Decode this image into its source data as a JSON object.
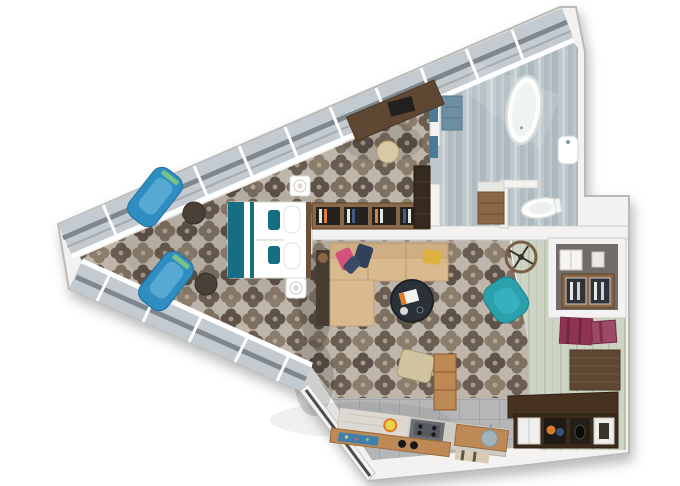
{
  "title": "hotel-suite-3d-floor-plan-top-view",
  "palette": {
    "wall": "#f3f2f0",
    "wall_edge": "#b9b9b6",
    "inner_wall_edge": "#d2d1cd",
    "glass": "#c3cad0",
    "glass_rail": "#7e878e",
    "carpet_bg": "#beb6aa",
    "carpet_dark": "#5e5349",
    "carpet_mid": "#7d7061",
    "carpet_light": "#8b7d6c",
    "carpet_deep": "#695c50",
    "bath_floor": "#bcc6cb",
    "bath_streak_dark": "#aeb9bf",
    "bath_streak_light": "#ced7da",
    "hall_floor": "#ced4c4",
    "hall_streak": "#b9c0ae",
    "kitchen_floor": "#b4b6b8",
    "kitchen_line": "#a4a7a9",
    "accent_teal": "#156e81",
    "chair_blue": "#2f8ec1",
    "chair_blue_light": "#57a8d3",
    "armchair_teal": "#2ba1ae",
    "sofa_tan": "#d9ba8e",
    "sofa_back": "#cfae83",
    "sofa_dark": "#473c31",
    "wood_dark": "#5f4833",
    "wood_mid": "#8a6747",
    "wood_light": "#bd8a55",
    "bench_wood": "#46321f",
    "table_navy": "#2b3139",
    "pillow_pink": "#d5507b",
    "pillow_navy": "#303f5a",
    "pillow_yellow": "#ddb13e",
    "mat_red": "#8f3353",
    "mat_red2": "#9c4a66",
    "niche_wall": "#716c67",
    "fridge_glass": "#2f343c",
    "towel_blue": "#4a7b96",
    "stool_beige": "#d8c9a4",
    "ottoman_beige": "#cfc49f",
    "kitchen_mat_blue": "#3e7fae",
    "white": "#ffffff"
  },
  "rooms": [
    {
      "name": "bedroom",
      "floor": "patterned-carpet",
      "furniture": [
        "double-bed-white-teal",
        "nightstand-with-lamp-top",
        "nightstand-with-lamp-bottom",
        "blue-lounge-chair-1",
        "blue-lounge-chair-2",
        "round-side-table-1",
        "round-side-table-2",
        "wall-desk-with-chair",
        "desk-stool",
        "low-bookshelf",
        "dark-wardrobe"
      ]
    },
    {
      "name": "bathroom",
      "floor": "grey-stone",
      "furniture": [
        "freestanding-bathtub",
        "wood-vanity",
        "toilet",
        "wall-hung-sink",
        "towel-shelf"
      ]
    },
    {
      "name": "living-room",
      "floor": "patterned-carpet",
      "furniture": [
        "corner-sofa-with-pillows",
        "round-coffee-table",
        "teal-accent-armchair",
        "beige-ottoman",
        "round-wheel-decor"
      ]
    },
    {
      "name": "kitchen",
      "floor": "grey-tile",
      "furniture": [
        "counter-with-cooktop",
        "wood-bar-front",
        "sink-counter",
        "tall-wood-cabinet",
        "fruit-plate"
      ]
    },
    {
      "name": "entry-hall",
      "floor": "pale-wood-planks",
      "furniture": [
        "minibar-niche-with-safe",
        "fridge-cabinet",
        "red-floor-mats",
        "wood-wall-panel",
        "shoe-bench-with-cubbies"
      ]
    }
  ],
  "windows": {
    "glazed_walls": 2,
    "style": "full-height window wall with mullions"
  }
}
